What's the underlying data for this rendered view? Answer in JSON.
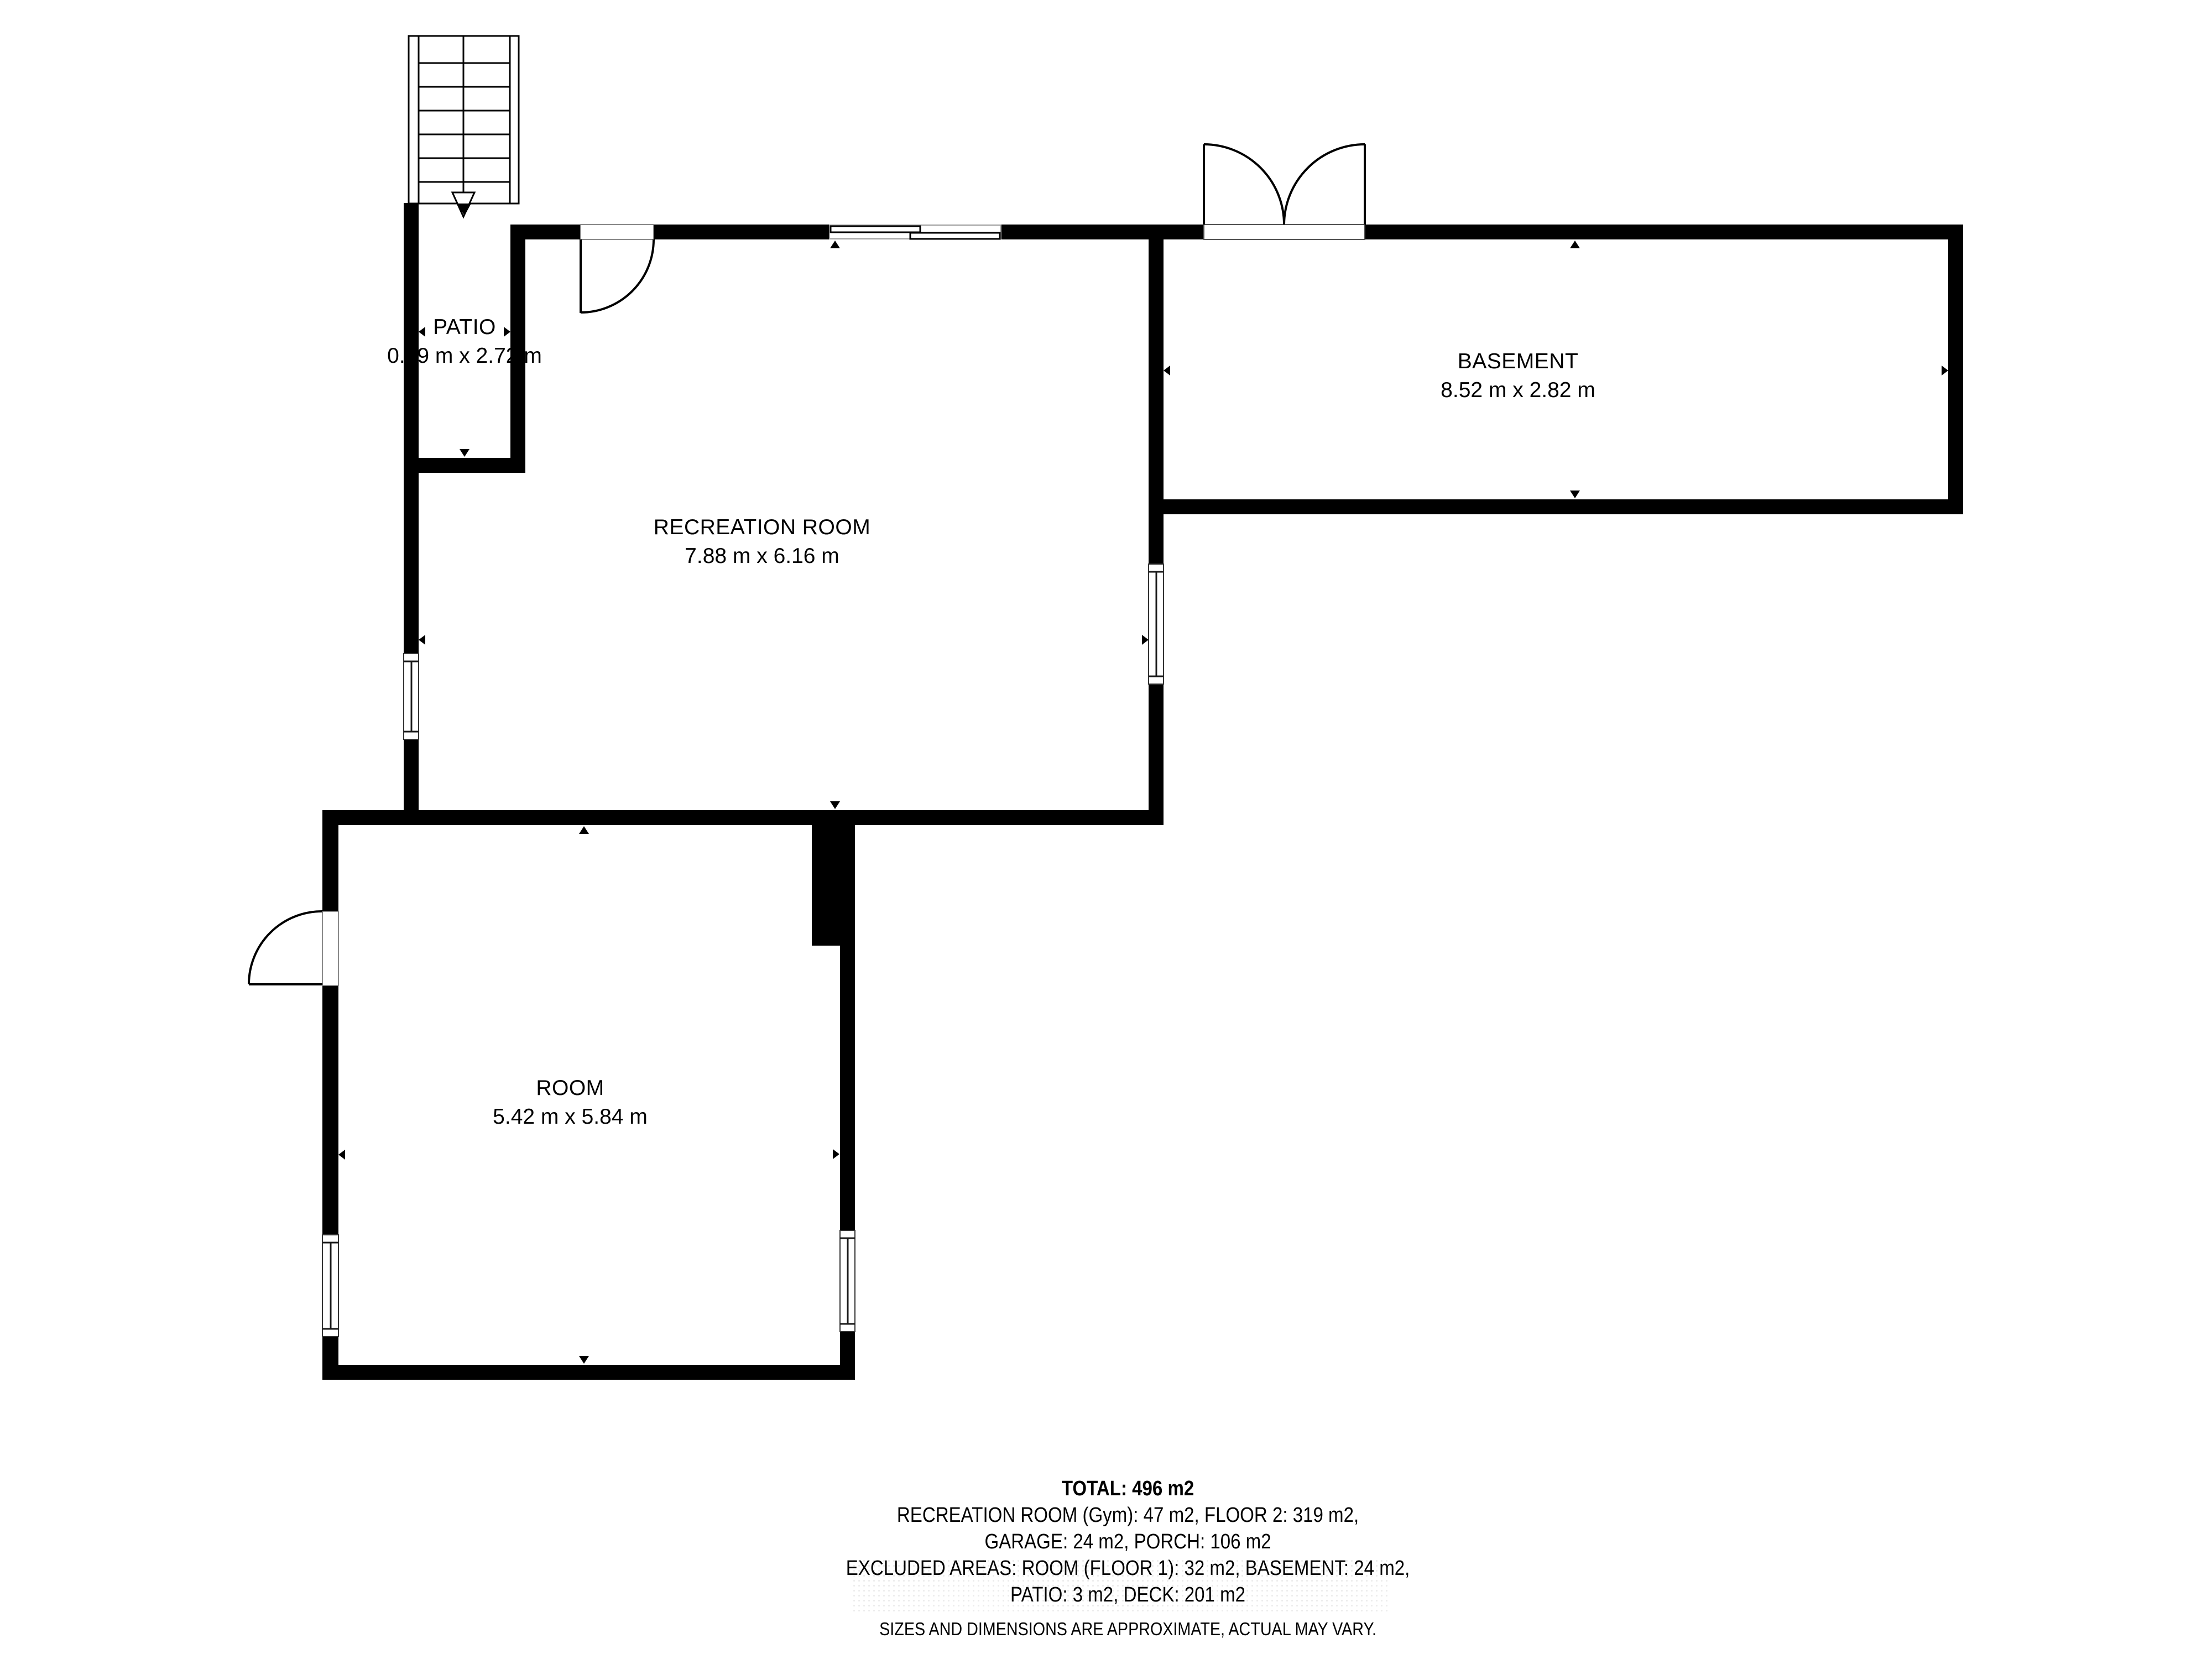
{
  "plan": {
    "rooms": [
      {
        "name": "PATIO",
        "dimensions": "0.99 m x 2.72 m"
      },
      {
        "name": "RECREATION ROOM",
        "dimensions": "7.88 m x 6.16 m"
      },
      {
        "name": "BASEMENT",
        "dimensions": "8.52 m x 2.82 m"
      },
      {
        "name": "ROOM",
        "dimensions": "5.42 m x 5.84 m"
      }
    ]
  },
  "summary": {
    "total": "TOTAL: 496 m2",
    "line2": "RECREATION ROOM (Gym): 47 m2, FLOOR 2: 319 m2,",
    "line3": "GARAGE: 24 m2, PORCH: 106 m2",
    "line4": "EXCLUDED AREAS: ROOM (FLOOR 1): 32 m2, BASEMENT: 24 m2,",
    "line5": "PATIO: 3 m2, DECK: 201 m2",
    "disclaimer": "SIZES AND DIMENSIONS ARE APPROXIMATE, ACTUAL MAY VARY."
  },
  "colors": {
    "wall": "#000000",
    "background": "#ffffff",
    "marker": "#000000"
  }
}
